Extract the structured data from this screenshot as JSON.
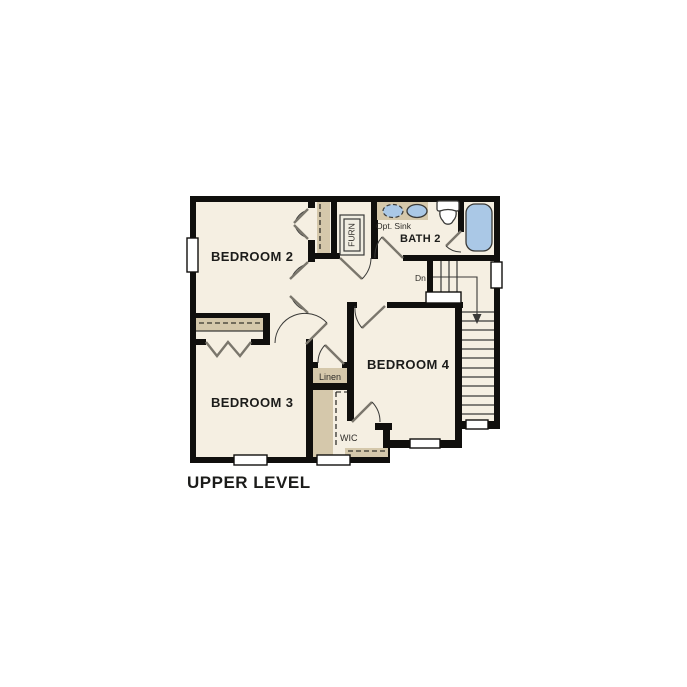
{
  "title": "UPPER LEVEL",
  "rooms": {
    "bedroom2": "BEDROOM 2",
    "bedroom3": "BEDROOM 3",
    "bedroom4": "BEDROOM 4",
    "bath2": "BATH 2"
  },
  "labels": {
    "furnace": "FURN",
    "opt_sink": "Opt. Sink",
    "linen": "Linen",
    "wic": "WIC",
    "down": "Dn"
  },
  "colors": {
    "wall": "#100f0d",
    "floor": "#f5efe2",
    "shelf": "#d5c8ab",
    "fixture": "#aac8e6",
    "line": "#3a3a38",
    "leaf": "#7a766c",
    "text": "#1c1c1a",
    "muted": "#2e2c28"
  }
}
